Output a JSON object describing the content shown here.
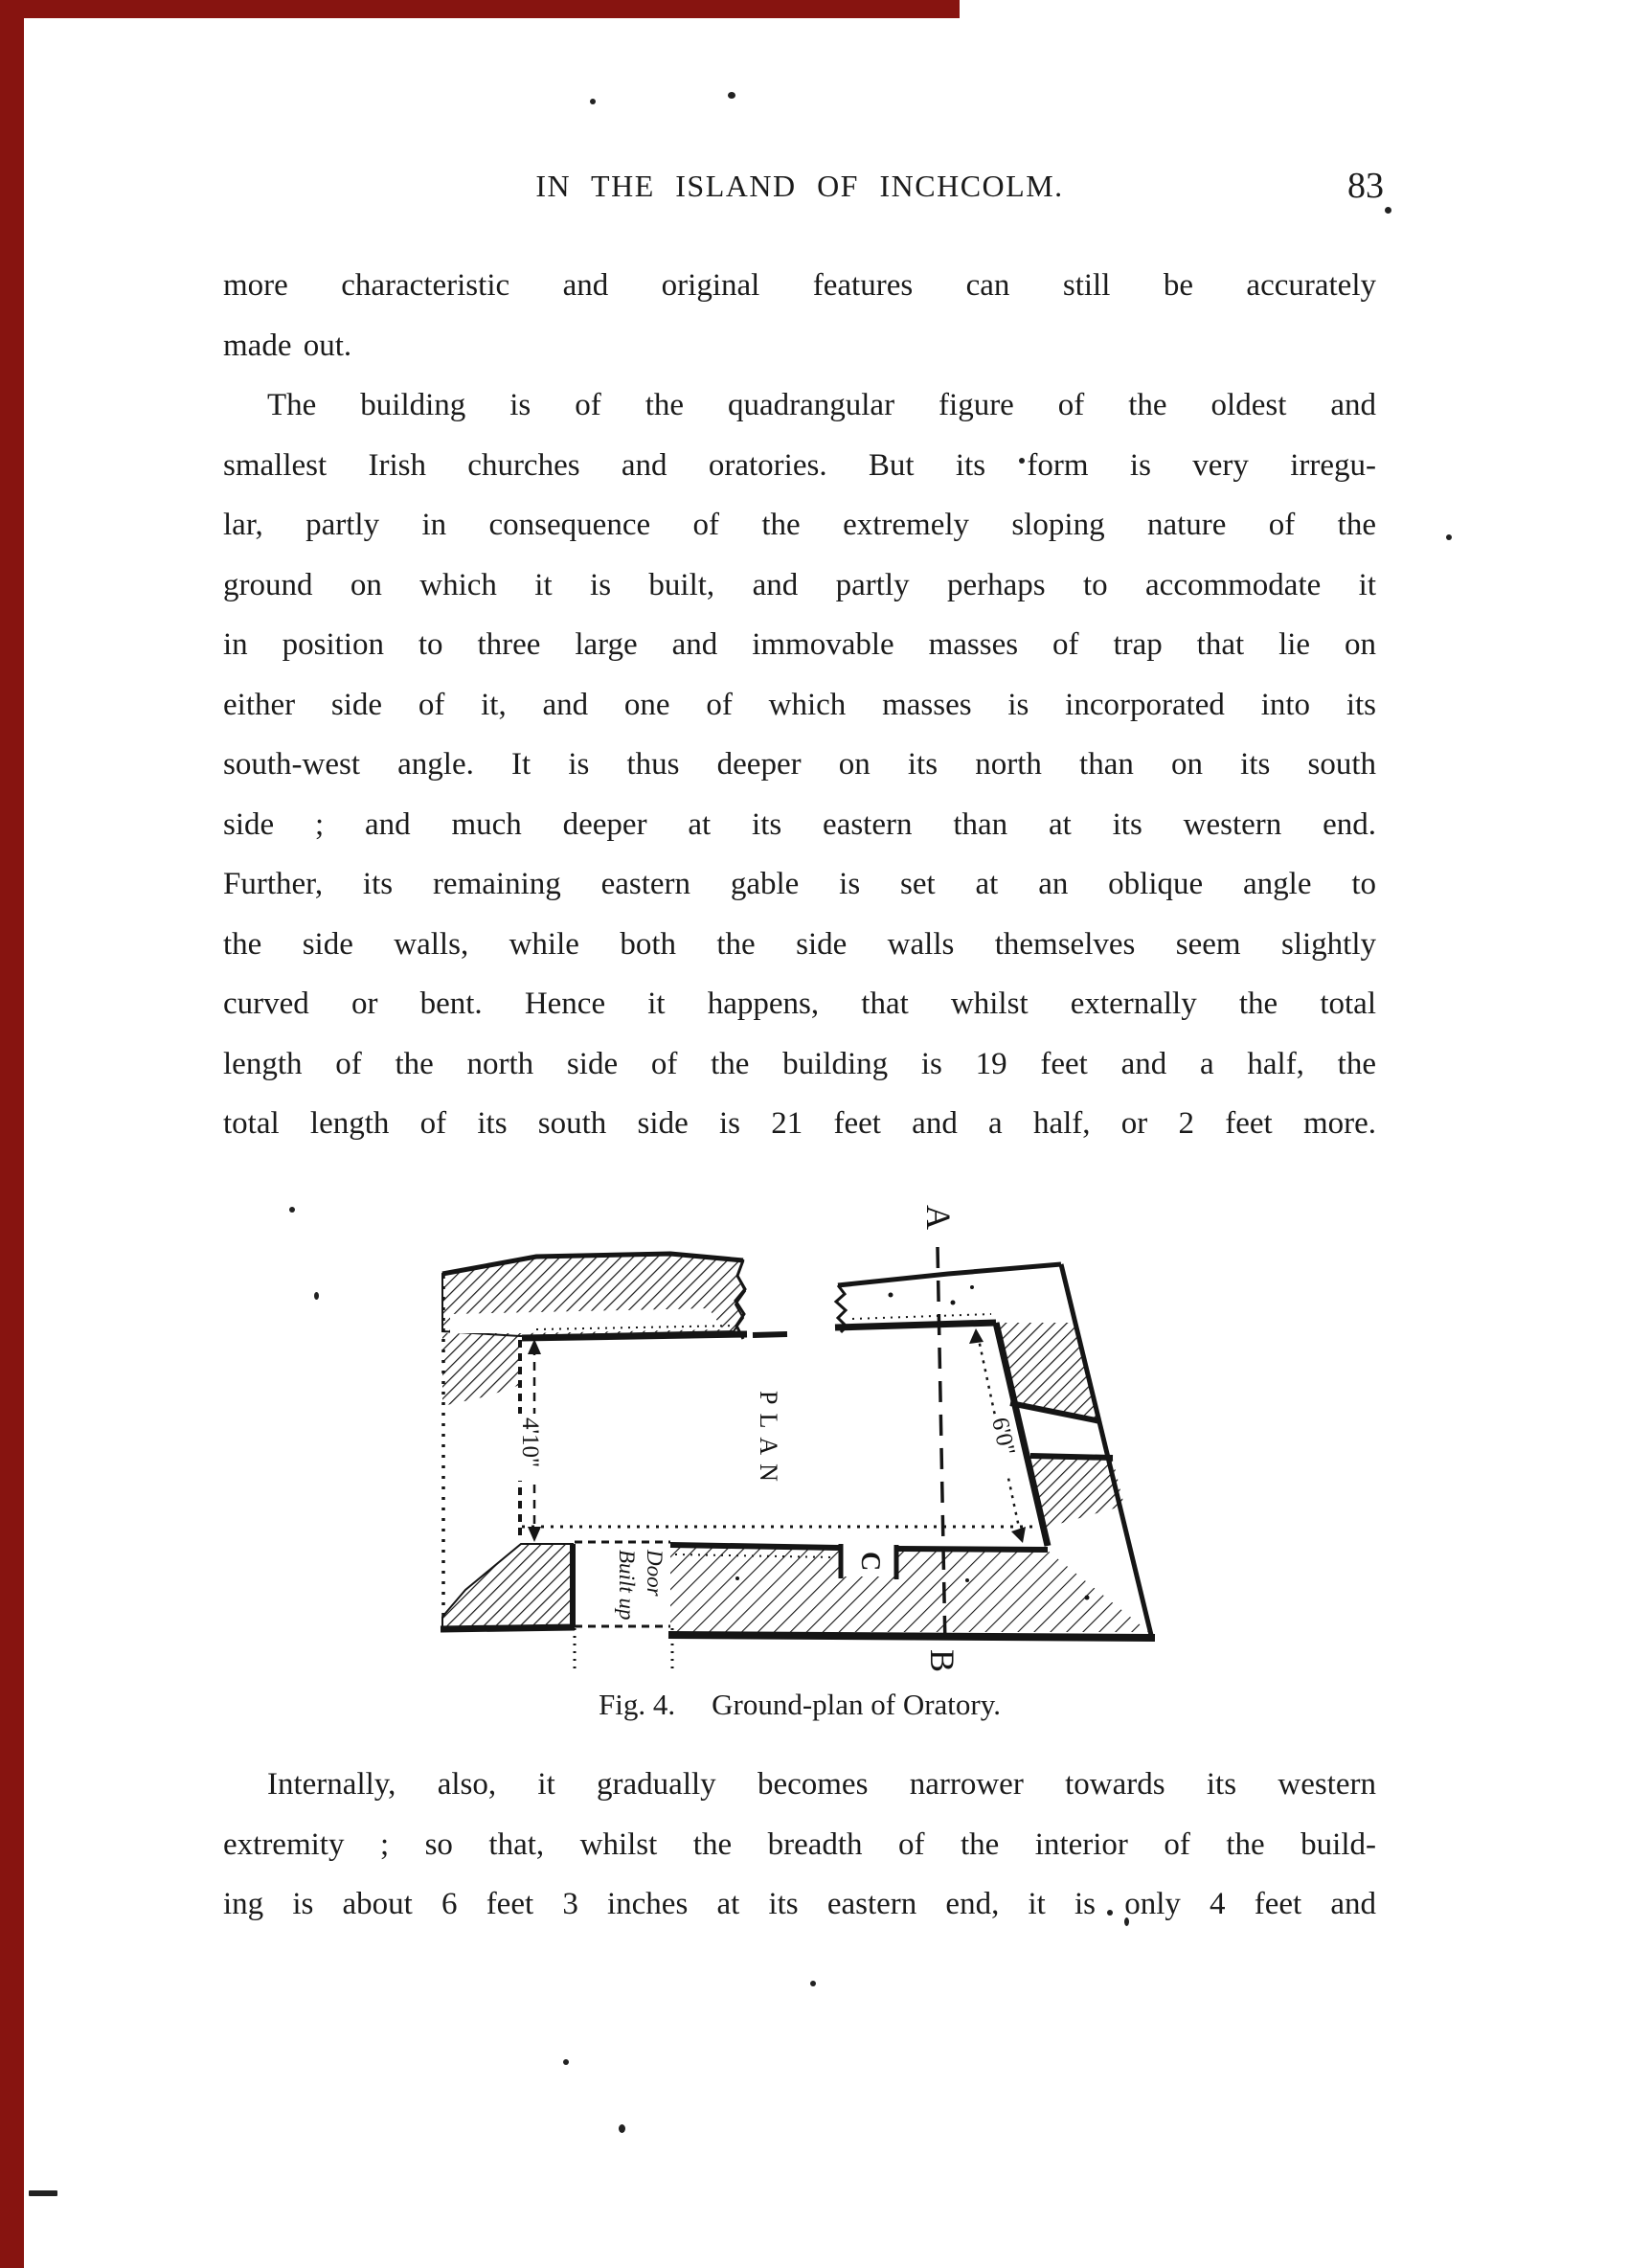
{
  "header": {
    "title": "IN THE ISLAND OF INCHCOLM.",
    "page_number": "83"
  },
  "body": {
    "para1": [
      "more characteristic and original features can still be accurately",
      "made out."
    ],
    "para2": [
      "The building is of the quadrangular figure of the oldest and",
      "smallest Irish churches and oratories.  But its form is very irregu-",
      "lar, partly in consequence of the extremely sloping nature of the",
      "ground on which it is built, and partly perhaps to accommodate it",
      "in position to three large and immovable masses of trap that lie on",
      "either side of it, and one of which masses is incorporated into its",
      "south-west angle.  It is thus deeper on its north than on its south",
      "side ; and much deeper at its eastern than at its western end.",
      "Further, its remaining eastern gable is set at an oblique angle to",
      "the side walls, while both the side walls themselves seem slightly",
      "curved or bent.  Hence it happens, that whilst externally the total",
      "length of the north side of the building is 19 feet and a half, the",
      "total length of its south side is 21 feet and a half, or 2 feet more."
    ],
    "para3": [
      "Internally, also, it gradually becomes narrower towards its western",
      "extremity ; so that, whilst the breadth of the interior of the build-",
      "ing is about 6 feet 3 inches at its eastern end, it is only 4 feet and"
    ]
  },
  "figure": {
    "label_a": "A",
    "label_b": "B",
    "label_c": "C",
    "plan_label": "PLAN",
    "dim_west": "4'10\"",
    "dim_east": "6'0\"",
    "door_label_line1": "Door",
    "door_label_line2": "Built up",
    "caption_fig": "Fig. 4.",
    "caption_title": "Ground-plan of Oratory."
  },
  "colors": {
    "ink": "#1b1b1b",
    "paper": "#ffffff",
    "scan_edge": "#871410"
  }
}
